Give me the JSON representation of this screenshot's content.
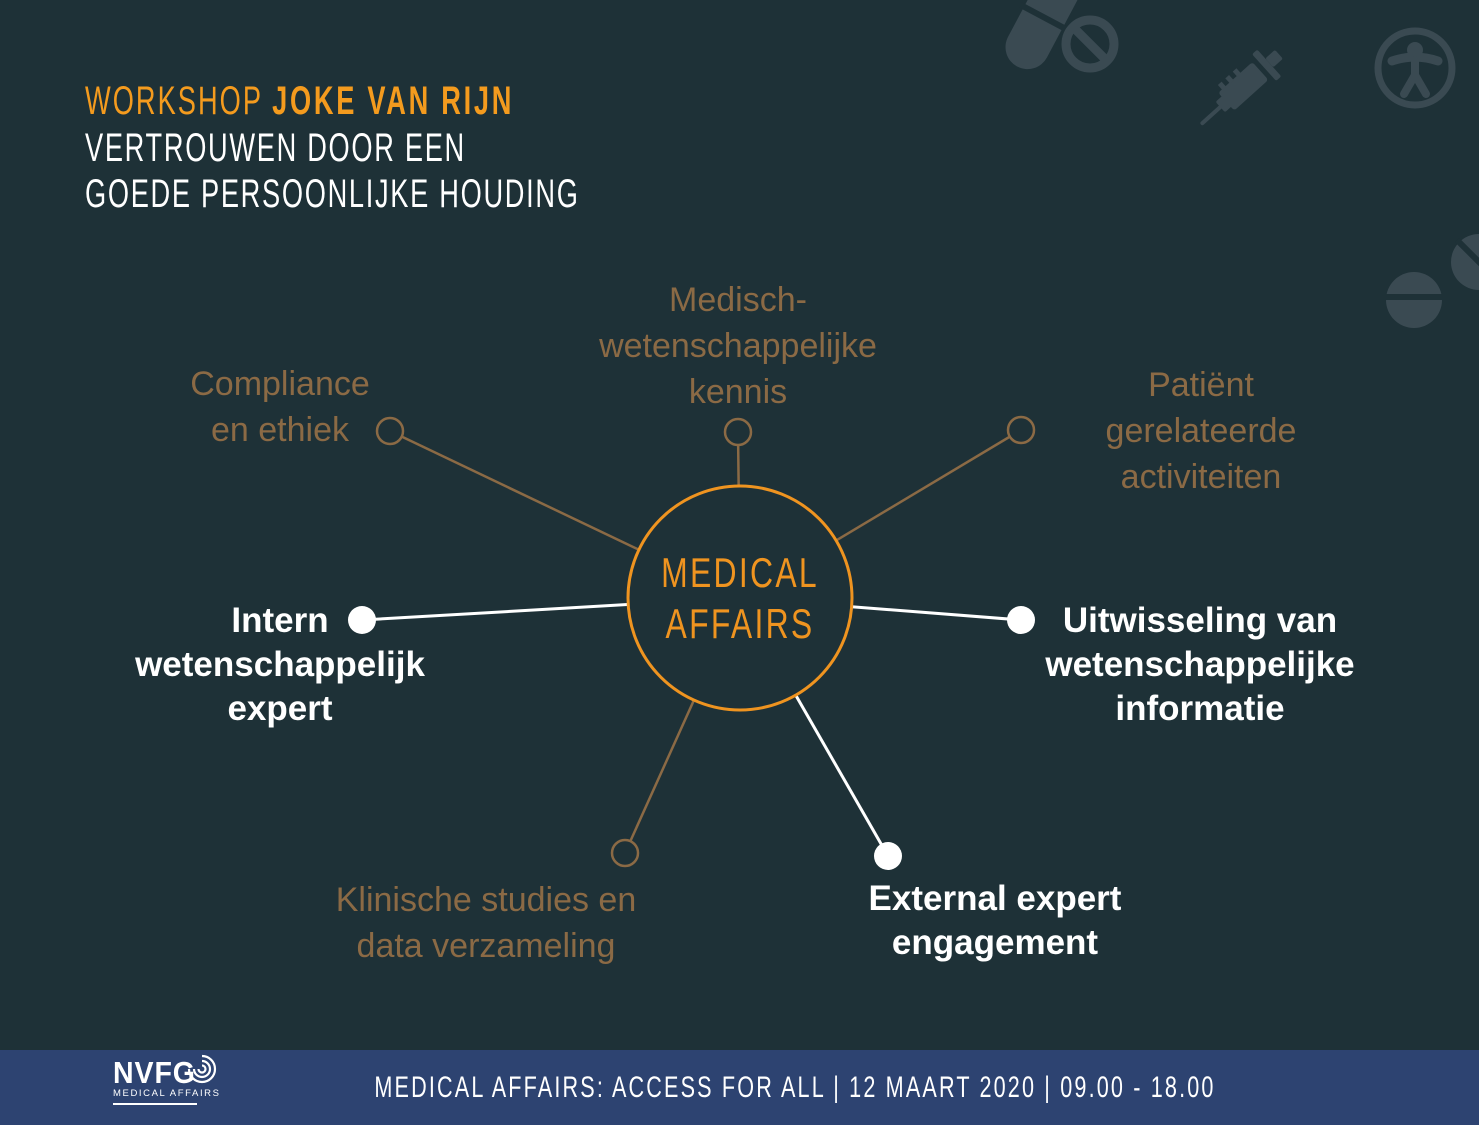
{
  "colors": {
    "background": "#1e3137",
    "accent_orange": "#ef9420",
    "title_orange": "#f49b1e",
    "muted_brown": "#8b6a45",
    "white": "#ffffff",
    "footer_blue": "#2d4371",
    "decor_icon": "#3a4a52"
  },
  "header": {
    "workshop_label": "WORKSHOP",
    "speaker": "JOKE VAN RIJN",
    "title_line1": "VERTROUWEN DOOR EEN",
    "title_line2": "GOEDE PERSOONLIJKE HOUDING"
  },
  "diagram": {
    "center": {
      "line1": "MEDICAL",
      "line2": "AFFAIRS"
    },
    "nodes": [
      {
        "id": "compliance",
        "emphasis": false,
        "lines": [
          "Compliance",
          "en ethiek"
        ]
      },
      {
        "id": "medisch",
        "emphasis": false,
        "lines": [
          "Medisch-",
          "wetenschappelijke",
          "kennis"
        ]
      },
      {
        "id": "patient",
        "emphasis": false,
        "lines": [
          "Patiënt",
          "gerelateerde",
          "activiteiten"
        ]
      },
      {
        "id": "intern",
        "emphasis": true,
        "lines": [
          "Intern",
          "wetenschappelijk",
          "expert"
        ]
      },
      {
        "id": "uitwisseling",
        "emphasis": true,
        "lines": [
          "Uitwisseling van",
          "wetenschappelijke",
          "informatie"
        ]
      },
      {
        "id": "klinische",
        "emphasis": false,
        "lines": [
          "Klinische studies en",
          "data verzameling"
        ]
      },
      {
        "id": "external",
        "emphasis": true,
        "lines": [
          "External expert",
          "engagement"
        ]
      }
    ]
  },
  "decorative_icons": [
    "capsule-icon",
    "prohibition-icon",
    "syringe-icon",
    "accessibility-icon",
    "tablet-icon",
    "tablet-diagonal-icon"
  ],
  "footer": {
    "logo_name": "NVFG",
    "logo_sub": "MEDICAL AFFAIRS",
    "banner": "MEDICAL AFFAIRS: ACCESS FOR ALL  |  12 MAART 2020  |  09.00 - 18.00"
  }
}
